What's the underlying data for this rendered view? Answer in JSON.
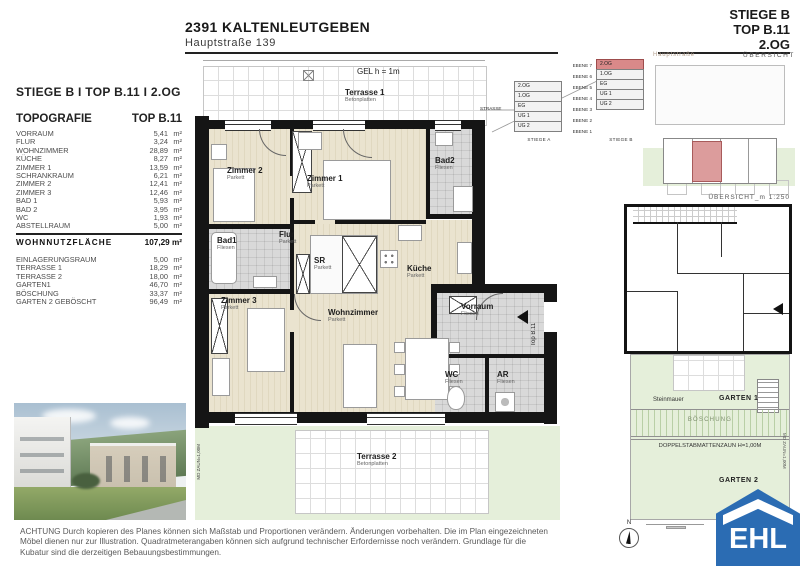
{
  "header": {
    "title": "2391 KALTENLEUTGEBEN",
    "subtitle": "Hauptstraße 139"
  },
  "unit_block": {
    "lines": [
      {
        "label": "STIEGE B"
      },
      {
        "label": "TOP B.11"
      },
      {
        "label": "2.OG"
      }
    ]
  },
  "left_panel": {
    "unit_line": "STIEGE B  I  TOP B.11  I  2.OG",
    "table_title": "TOPOGRAFIE",
    "table_unit": "TOP B.11",
    "rooms": [
      {
        "label": "VORRAUM",
        "value": "5,41",
        "unit": "m²"
      },
      {
        "label": "FLUR",
        "value": "3,24",
        "unit": "m²"
      },
      {
        "label": "WOHNZIMMER",
        "value": "28,89",
        "unit": "m²"
      },
      {
        "label": "KÜCHE",
        "value": "8,27",
        "unit": "m²"
      },
      {
        "label": "ZIMMER 1",
        "value": "13,59",
        "unit": "m²"
      },
      {
        "label": "SCHRANKRAUM",
        "value": "6,21",
        "unit": "m²"
      },
      {
        "label": "ZIMMER 2",
        "value": "12,41",
        "unit": "m²"
      },
      {
        "label": "ZIMMER 3",
        "value": "12,46",
        "unit": "m²"
      },
      {
        "label": "BAD 1",
        "value": "5,93",
        "unit": "m²"
      },
      {
        "label": "BAD 2",
        "value": "3,95",
        "unit": "m²"
      },
      {
        "label": "WC",
        "value": "1,93",
        "unit": "m²"
      },
      {
        "label": "ABSTELLRAUM",
        "value": "5,00",
        "unit": "m²"
      }
    ],
    "total": {
      "label": "WOHNNUTZFLÄCHE",
      "value": "107,29 m²"
    },
    "extras": [
      {
        "label": "EINLAGERUNGSRAUM",
        "value": "5,00",
        "unit": "m²"
      },
      {
        "label": "TERRASSE 1",
        "value": "18,29",
        "unit": "m²"
      },
      {
        "label": "TERRASSE 2",
        "value": "18,00",
        "unit": "m²"
      },
      {
        "label": "GARTEN1",
        "value": "46,70",
        "unit": "m²"
      },
      {
        "label": "BÖSCHUNG",
        "value": "33,37",
        "unit": "m²"
      },
      {
        "label": "GARTEN 2 GEBÖSCHT",
        "value": "96,49",
        "unit": "m²"
      }
    ]
  },
  "floorplan": {
    "gel_note": "GEL h = 1m",
    "entrance_label": "Top B.11",
    "fence_label": "MD ZAUN=1,00M",
    "rooms": {
      "terrasse1": {
        "name": "Terrasse 1",
        "floor": "Betonplatten"
      },
      "zimmer1": {
        "name": "Zimmer 1",
        "floor": "Parkett"
      },
      "zimmer2": {
        "name": "Zimmer 2",
        "floor": "Parkett"
      },
      "zimmer3": {
        "name": "Zimmer 3",
        "floor": "Parkett"
      },
      "bad1": {
        "name": "Bad1",
        "floor": "Fliesen"
      },
      "bad2": {
        "name": "Bad2",
        "floor": "Fliesen"
      },
      "flur": {
        "name": "Flur",
        "floor": "Parkett"
      },
      "sr": {
        "name": "SR",
        "floor": "Parkett"
      },
      "kueche": {
        "name": "Küche",
        "floor": "Parkett"
      },
      "wohnzimmer": {
        "name": "Wohnzimmer",
        "floor": "Parkett"
      },
      "vorraum": {
        "name": "Vorraum",
        "floor": "Fliesen"
      },
      "wc": {
        "name": "WC",
        "floor": "Fliesen"
      },
      "ar": {
        "name": "AR",
        "floor": "Fliesen"
      },
      "terrasse2": {
        "name": "Terrasse 2",
        "floor": "Betonplatten"
      }
    }
  },
  "level_diagram": {
    "street_label": "STRASSE",
    "ebene": [
      {
        "label": "EBENE 7"
      },
      {
        "label": "EBENE 6"
      },
      {
        "label": "EBENE 5"
      },
      {
        "label": "EBENE 4"
      },
      {
        "label": "EBENE 3"
      },
      {
        "label": "EBENE 2"
      },
      {
        "label": "EBENE 1"
      }
    ],
    "stiege_a": {
      "label": "STIEGE A",
      "levels": [
        {
          "label": "2.OG"
        },
        {
          "label": "1.OG"
        },
        {
          "label": "EG"
        },
        {
          "label": "UG 1"
        },
        {
          "label": "UG 2"
        }
      ]
    },
    "stiege_b": {
      "label": "STIEGE B",
      "levels": [
        {
          "label": "2.OG",
          "hl": true
        },
        {
          "label": "1.OG"
        },
        {
          "label": "EG"
        },
        {
          "label": "UG 1"
        },
        {
          "label": "UG 2"
        }
      ]
    },
    "highlight_color": "#d98989"
  },
  "site_overview": {
    "street_label": "Hauptstraße",
    "title": "ÜBERSICHT"
  },
  "detail_overview": {
    "title": "ÜBERSICHT_m 1:250",
    "garden": {
      "steinmauer": "Steinmauer",
      "garten1": "GARTEN 1",
      "boeschung": "BÖSCHUNG",
      "fence": "DOPPELSTABMATTENZAUN H=1,00M",
      "garten2": "GARTEN 2",
      "fence_right": "MD ZAUN=1,00M"
    }
  },
  "footer": {
    "disclaimer": [
      {
        "text": "ACHTUNG Durch kopieren des Planes können sich Maßstab und Proportionen verändern. Änderungen vorbehalten. Die im Plan eingezeichneten"
      },
      {
        "text": "Möbel dienen nur zur Illustration. Quadratmeterangaben können sich aufgrund technischer Erfordernisse noch verändern. Grundlage für die"
      },
      {
        "text": "Kubatur sind die derzeitigen Bebauungsbestimmungen."
      }
    ],
    "north_label": "N"
  },
  "logo": {
    "text": "EHL",
    "color": "#2b6cb3"
  }
}
